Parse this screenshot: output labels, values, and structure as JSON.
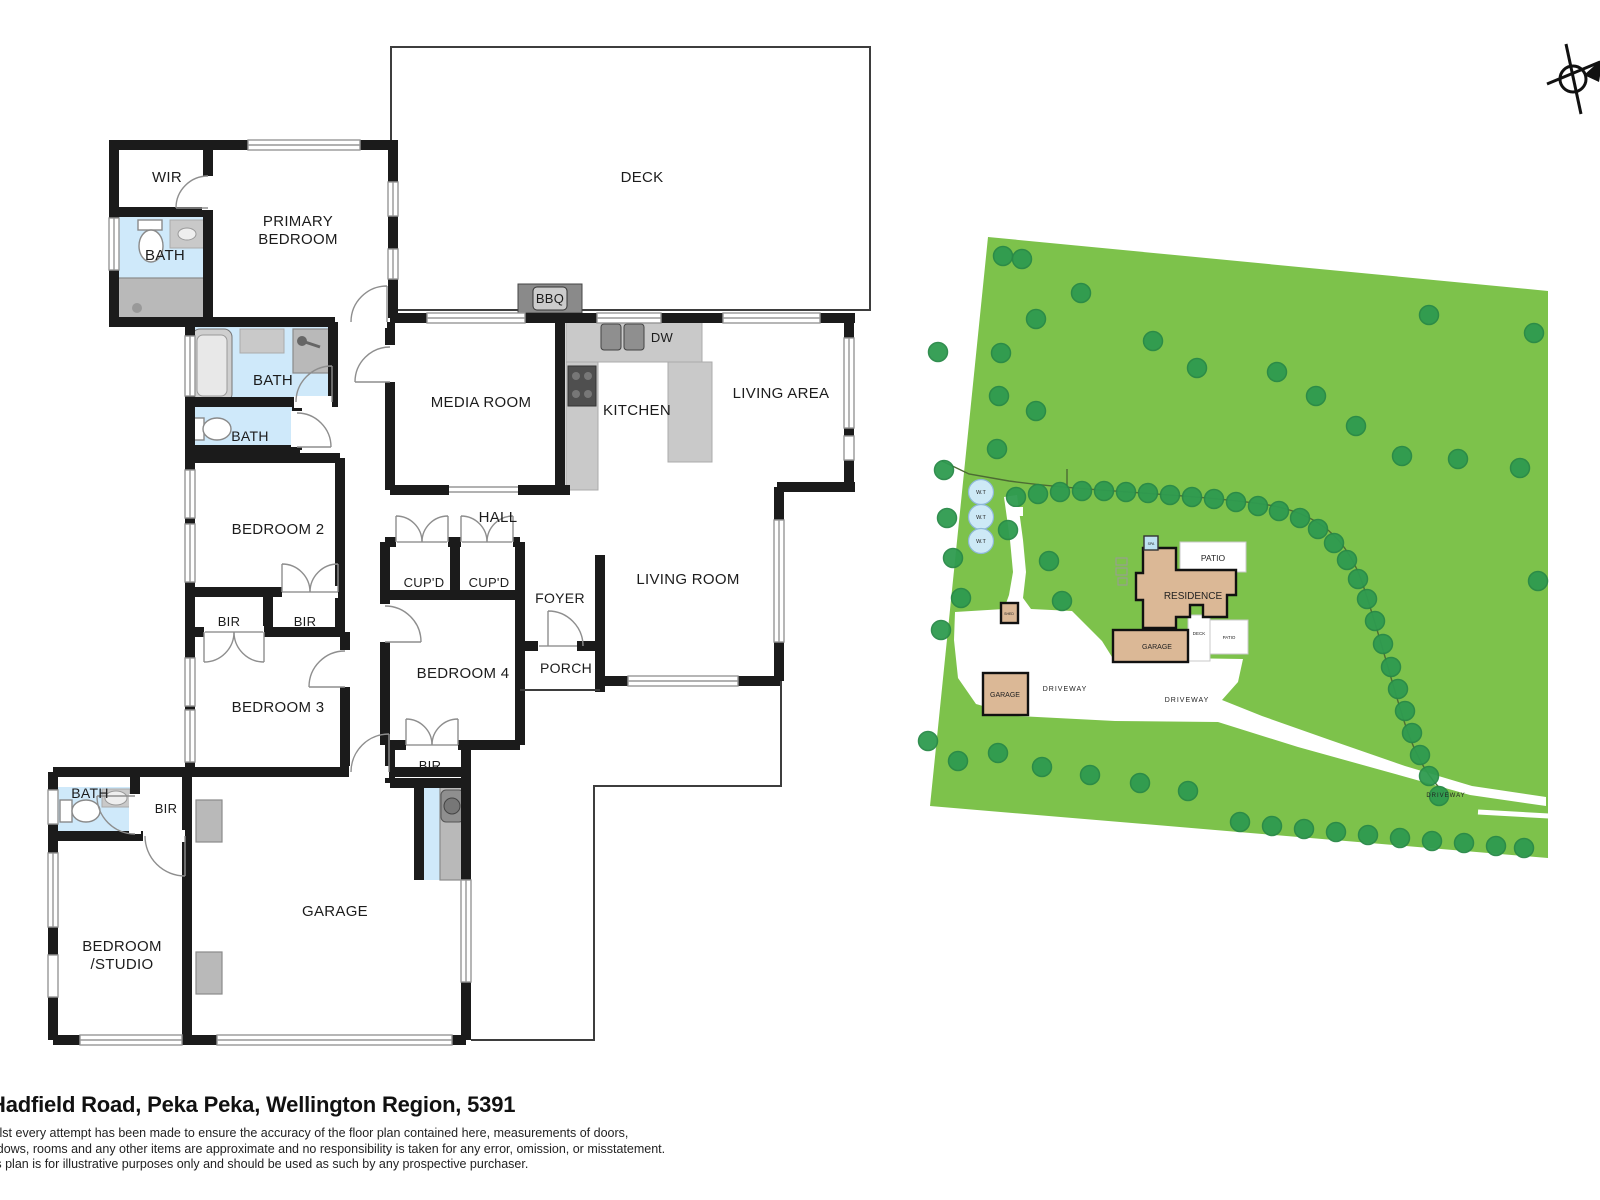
{
  "footer": {
    "address": "Hadfield Road, Peka Peka, Wellington Region, 5391",
    "disclaimer": [
      "Whilst every attempt has been made to ensure the accuracy of the floor plan contained here, measurements of doors,",
      "windows, rooms and any other items are approximate and no responsibility is taken for any error, omission, or misstatement.",
      "This plan is for illustrative purposes only and should be used as such by any prospective purchaser."
    ]
  },
  "floor_plan": {
    "labels": {
      "wir": "WIR",
      "bath1": "BATH",
      "primary1": "PRIMARY",
      "primary2": "BEDROOM",
      "deck": "DECK",
      "bbq": "BBQ",
      "media": "MEDIA ROOM",
      "dw": "DW",
      "kitchen": "KITCHEN",
      "living_area": "LIVING AREA",
      "bath2": "BATH",
      "bath3": "BATH",
      "bedroom2": "BEDROOM 2",
      "hall": "HALL",
      "cupd1": "CUP'D",
      "cupd2": "CUP'D",
      "foyer": "FOYER",
      "living_room": "LIVING ROOM",
      "bir1": "BIR",
      "bir2": "BIR",
      "bedroom3": "BEDROOM 3",
      "bedroom4": "BEDROOM 4",
      "porch": "PORCH",
      "bir3": "BIR",
      "bath4": "BATH",
      "bir4": "BIR",
      "garage": "GARAGE",
      "studio1": "BEDROOM",
      "studio2": "/STUDIO"
    },
    "colors": {
      "wall": "#1b1b1b",
      "bath_fill": "#cfe9fa",
      "fixture_gray": "#b9b9b9"
    }
  },
  "site_plan": {
    "labels": {
      "residence": "RESIDENCE",
      "patio": "PATIO",
      "patio_small": "PATIO",
      "deck": "DECK",
      "garage_attached": "GARAGE",
      "garage_detached": "GARAGE",
      "shed": "SHED",
      "spa": "SPA",
      "wt": "W.T",
      "driveway": "DRIVEWAY"
    },
    "colors": {
      "grass": "#7dc24b",
      "tree": "#2f9b50",
      "building": "#dbb896",
      "driveway": "#ffffff",
      "tank": "#cde9f6"
    },
    "trees": [
      [
        1003,
        256
      ],
      [
        1022,
        259
      ],
      [
        1081,
        293
      ],
      [
        1036,
        319
      ],
      [
        1001,
        353
      ],
      [
        1153,
        341
      ],
      [
        1197,
        368
      ],
      [
        1277,
        372
      ],
      [
        1316,
        396
      ],
      [
        1356,
        426
      ],
      [
        1402,
        456
      ],
      [
        1458,
        459
      ],
      [
        1520,
        468
      ],
      [
        1534,
        333
      ],
      [
        1429,
        315
      ],
      [
        999,
        396
      ],
      [
        1036,
        411
      ],
      [
        997,
        449
      ],
      [
        938,
        352
      ],
      [
        1538,
        581
      ],
      [
        1016,
        497
      ],
      [
        1038,
        494
      ],
      [
        1060,
        492
      ],
      [
        1082,
        491
      ],
      [
        1104,
        491
      ],
      [
        1126,
        492
      ],
      [
        1148,
        493
      ],
      [
        1170,
        495
      ],
      [
        1192,
        497
      ],
      [
        1214,
        499
      ],
      [
        1236,
        502
      ],
      [
        1258,
        506
      ],
      [
        1279,
        511
      ],
      [
        1300,
        518
      ],
      [
        1318,
        529
      ],
      [
        1334,
        543
      ],
      [
        1347,
        560
      ],
      [
        1358,
        579
      ],
      [
        1367,
        599
      ],
      [
        1375,
        621
      ],
      [
        1383,
        644
      ],
      [
        1391,
        667
      ],
      [
        1398,
        689
      ],
      [
        1405,
        711
      ],
      [
        1412,
        733
      ],
      [
        1420,
        755
      ],
      [
        1429,
        776
      ],
      [
        1439,
        796
      ],
      [
        944,
        470
      ],
      [
        947,
        518
      ],
      [
        953,
        558
      ],
      [
        961,
        598
      ],
      [
        941,
        630
      ],
      [
        1008,
        530
      ],
      [
        1049,
        561
      ],
      [
        1062,
        601
      ],
      [
        928,
        741
      ],
      [
        958,
        761
      ],
      [
        998,
        753
      ],
      [
        1042,
        767
      ],
      [
        1090,
        775
      ],
      [
        1140,
        783
      ],
      [
        1188,
        791
      ],
      [
        1240,
        822
      ],
      [
        1272,
        826
      ],
      [
        1304,
        829
      ],
      [
        1336,
        832
      ],
      [
        1368,
        835
      ],
      [
        1400,
        838
      ],
      [
        1432,
        841
      ],
      [
        1464,
        843
      ],
      [
        1496,
        846
      ],
      [
        1524,
        848
      ]
    ]
  }
}
